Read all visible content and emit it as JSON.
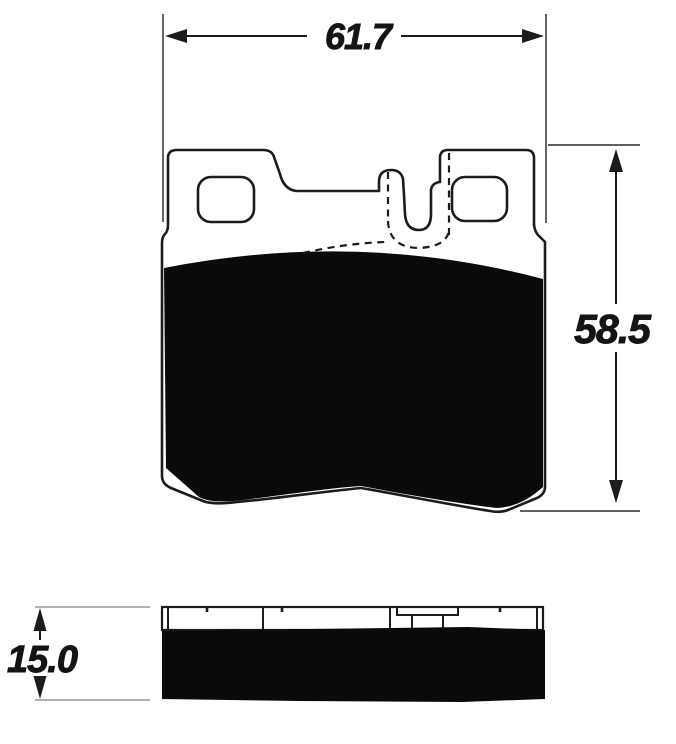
{
  "front_view": {
    "width_dimension_label": "61.7",
    "height_dimension_label": "58.5"
  },
  "side_view": {
    "thickness_dimension_label": "15.0"
  },
  "colors": {
    "line": "#1c1c1c",
    "friction": "#0a0a0a",
    "plate": "#ffffff",
    "ext_dark": "#4a4a4a",
    "ext_light": "#a6a6a6",
    "background": "#ffffff",
    "label": "#141414"
  }
}
